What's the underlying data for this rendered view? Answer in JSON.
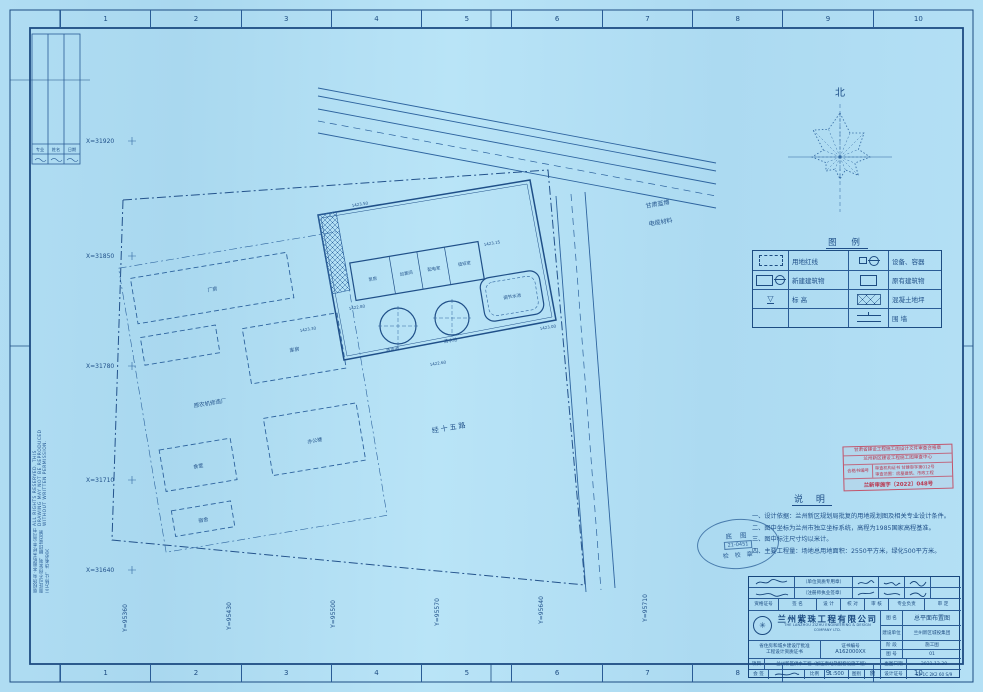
{
  "sheet": {
    "grid_numbers_top": [
      "1",
      "2",
      "3",
      "4",
      "5",
      "6",
      "7",
      "8",
      "9",
      "10"
    ],
    "grid_numbers_bottom": [
      "1",
      "2",
      "3",
      "4",
      "5",
      "6",
      "7",
      "8",
      "9",
      "10"
    ],
    "copyright_cn": "版权所有·本图纸未经本公司书面许可不得复制、翻印或向第三方转让，违者必究",
    "copyright_en": "ALL RIGHTS RESERVED. THIS DRAWING MAY NOT BE REPRODUCED WITHOUT WRITTEN PERMISSION.",
    "signbar": {
      "c1": "专业",
      "c2": "姓名",
      "c3": "日期"
    }
  },
  "compass": {
    "north_label": "北"
  },
  "plan": {
    "x_coords": [
      "X=31920",
      "X=31850",
      "X=31780",
      "X=31710",
      "X=31640"
    ],
    "y_coords": [
      "Y=95360",
      "Y=95430",
      "Y=95500",
      "Y=95570",
      "Y=95640",
      "Y=95710"
    ],
    "road_label": "经十五路",
    "neighbor_right_1": "甘肃蓝博",
    "neighbor_right_2": "电缆材料",
    "neighbor_left": "原农机修造厂",
    "buildings": {
      "factory": "厂房",
      "warehouse": "库房",
      "canteen": "食堂",
      "office": "办公楼",
      "dorm": "宿舍",
      "pump": "泵房",
      "chlorine": "加氯间",
      "power": "配电室",
      "duty": "值班室",
      "tank1": "清水池",
      "tank2": "清水池",
      "basin": "调节水池"
    },
    "elevations": [
      "1423.50",
      "1423.15",
      "1422.80",
      "1423.00",
      "1422.60",
      "1423.30"
    ]
  },
  "legend": {
    "title": "图 例",
    "r1_left": "用地红线",
    "r1_right": "设备、容器",
    "r2_left": "新建建筑物",
    "r2_right": "原有建筑物",
    "r3_left": "标  高",
    "r3_right": "混凝土地坪",
    "r4_right": "围  墙"
  },
  "red_stamp": {
    "line1": "甘肃省建设工程施工图设计文件审查合格章",
    "line2": "兰州新区建设工程施工图审查中心",
    "box_label": "合格书编号",
    "detail1": "审查机构证书 甘建审字第012号",
    "detail2": "审查范围：房屋建筑、市政工程",
    "line4": "兰新审施字〔2022〕048号"
  },
  "notes": {
    "title": "说  明",
    "items": [
      "一、设计依据：兰州新区规划局批复的用地规划图及相关专业设计条件。",
      "二、图中坐标为兰州市独立坐标系统，高程为1985国家高程基准。",
      "三、图中标注尺寸均以米计。",
      "四、主要工程量：场地总用地面积：2550平方米，绿化500平方米。"
    ]
  },
  "oval_stamp": {
    "line1": "底  图",
    "line2": "21-0451",
    "line3": "检 校 章"
  },
  "titleblock": {
    "company_cn": "兰州紫珠工程有限公司",
    "company_en": "THE LANZHOU ZIZHU ENGINEERING & DESIGN COMPANY LTD.",
    "seal_note1": "（单位资质专用章）",
    "seal_note2": "（注册师执业签章）",
    "headers": [
      "资格证号",
      "签  名",
      "设 计",
      "校 对",
      "审 核",
      "专业负责",
      "审 定"
    ],
    "title_label": "图 名",
    "title_value": "总平面布置图",
    "client_label": "建设单位",
    "client_value": "兰州新区城投集团",
    "stage_label": "阶 段",
    "stage_value": "施工图",
    "sheet_no_label": "图 号",
    "sheet_no_value": "01",
    "cert_line1": "省住房和城乡建设厅批准",
    "cert_line2": "工程设计资质证书",
    "cert_no_label": "证书编号",
    "cert_no_value": "A162000XX",
    "project_label": "项目",
    "project_value": "兰州新区供水工程（加压泵站及配套设施工程）",
    "date_label": "出图日期",
    "date_value": "2021.12.30",
    "countersign_label": "会 签",
    "scale_label": "比例",
    "scale_value": "1:500",
    "type_label": "图别",
    "type_value": "施",
    "design_cert_label": "设计证号",
    "design_cert_value": "S2-1C 2K2 60 S/9"
  }
}
